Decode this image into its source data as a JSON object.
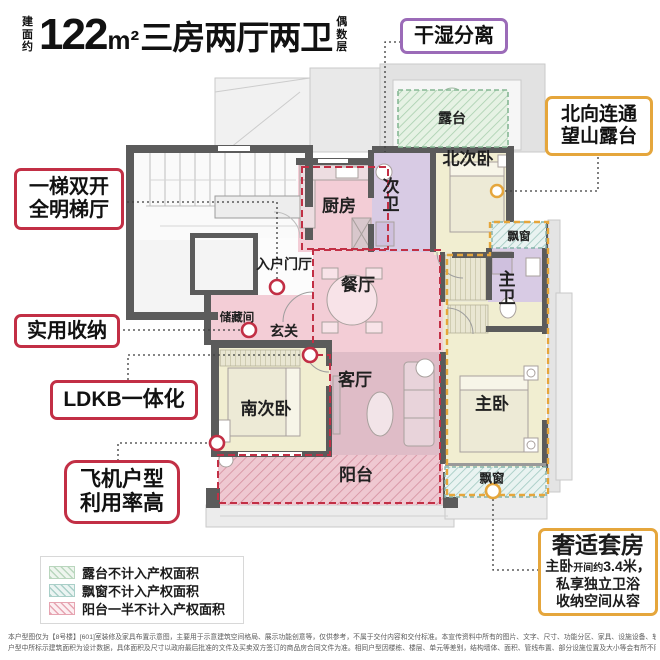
{
  "title": {
    "prefix_vertical": "建面约",
    "num": "122",
    "unit": "m²",
    "text": "三房两厅两卫",
    "suffix_vertical": "偶数层"
  },
  "callouts": {
    "dry_wet": {
      "label": "干湿分离"
    },
    "north_terrace": {
      "line1": "北向连通",
      "line2": "望山露台"
    },
    "stair": {
      "line1": "一梯双开",
      "line2": "全明梯厅"
    },
    "storage": {
      "label": "实用收纳"
    },
    "ldkb": {
      "label": "LDKB一体化"
    },
    "plane": {
      "line1": "飞机户型",
      "line2": "利用率高"
    },
    "suite": {
      "title": "奢适套房",
      "line1_a": "主卧",
      "line1_b": "开间约",
      "line1_c": "3.4米，",
      "line2": "私享独立卫浴",
      "line3": "收纳空间从容"
    }
  },
  "rooms": {
    "terrace": "露台",
    "kitchen": "厨房",
    "bath_second": "次卫",
    "bedroom_north": "北次卧",
    "entry_hall": "入户门厅",
    "dining": "餐厅",
    "storage_room": "储藏间",
    "foyer": "玄关",
    "living": "客厅",
    "bedroom_south": "南次卧",
    "bedroom_master": "主卧",
    "bath_master": "主卫",
    "balcony": "阳台",
    "bay_window_right": "飘窗",
    "bay_window_bottom": "飘窗"
  },
  "legend": {
    "items": [
      {
        "label": "露台不计入产权面积"
      },
      {
        "label": "飘窗不计入产权面积"
      },
      {
        "label": "阳台一半不计入产权面积"
      }
    ]
  },
  "disclaimer": {
    "line1": "本户型图仅为【8号楼】[601]室装修及家具布置示意图，主要用于示意建筑空间格局、展示功能创意等，仅供参考，不属于交付内容和交付标准。本宣传资料中所有的图片、文字、尺寸、功能分区、家具、设施设备、软装摆设等仅为示意参考，不作为要约或承诺，非交付标准。",
    "line2": "户型中所标示建筑面积为设计数据，具体面积及尺寸以政府最后批准的文件及买卖双方签订的商品房合同文件为准。相同户型因楼栋、楼层、单元等差别，结构墙体、面积、管线布置、部分设施位置及大小等会有所不同，仅供参考，具体交付单位楼层最终应以实际交付为准。"
  },
  "colors": {
    "accent_red": "#c22f45",
    "accent_purple": "#9b6bb8",
    "accent_orange": "#e5a63c",
    "room_pink": "#f3cdd6",
    "room_living_pink": "#dfbcc7",
    "room_yellow": "#f1eed1",
    "room_purple": "#d8cbe4",
    "terrace_green": "#e3f0e2",
    "wall_gray": "#5b5b5b"
  }
}
